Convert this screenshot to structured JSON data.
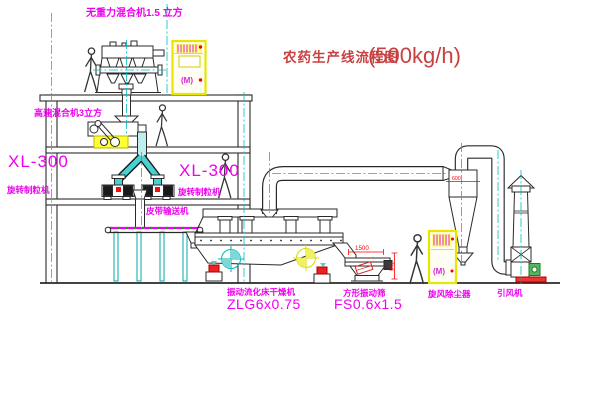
{
  "diagram": {
    "title_cn": "农药生产线流程图",
    "title_capacity": "(500kg/h)"
  },
  "labels": {
    "gravity_mixer": "无重力混合机1.5 立方",
    "high_speed_mixer": "高速混合机3立方",
    "granulator_left_model": "XL-300",
    "granulator_left_name": "旋转制粒机",
    "granulator_right_model": "XL-300",
    "granulator_right_name": "旋转制粒机",
    "belt_conveyor": "皮带输送机",
    "dryer_name": "振动流化床干燥机",
    "dryer_model": "ZLG6x0.75",
    "screen_name": "方形振动筛",
    "screen_model": "FS0.6x1.5",
    "cyclone": "旋风除尘器",
    "fan": "引风机"
  },
  "dims": {
    "screen_len": "1500",
    "screen_h": "541",
    "cyclone_dia": "600"
  },
  "cabinet": {
    "mark": "(M)"
  },
  "colors": {
    "label_magenta": "#ee00ee",
    "title_red": "#c94040",
    "line": "#2a2a2a",
    "centerline_cyan": "#00bcbc",
    "chute_cyan": "#49d0d0",
    "cabinet_yellow": "#e6e600",
    "dim_red": "#ff0000",
    "motor_green": "#57b55f"
  }
}
